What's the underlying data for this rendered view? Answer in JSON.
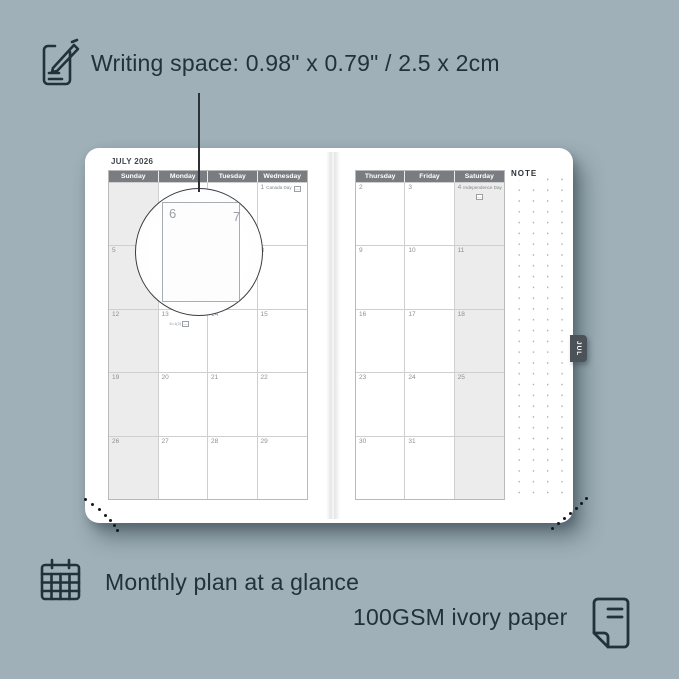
{
  "colors": {
    "background": "#9fb0b8",
    "ink": "#22313a",
    "calendar_header_bg": "#797d82",
    "calendar_header_text": "#ffffff",
    "shaded_column": "#ececec",
    "grid_line": "#cfcfcf",
    "date_text": "#8b9096",
    "month_tab_bg": "#4b5258",
    "note_dot": "#aeb2b6"
  },
  "top_annotation": {
    "text": "Writing space: 0.98\" x 0.79\" / 2.5 x 2cm"
  },
  "bottom_annotations": {
    "monthly": "Monthly plan at a glance",
    "paper": "100GSM ivory paper"
  },
  "planner": {
    "month_title": "JULY 2026",
    "tab_label": "JUL",
    "note_label": "NOTE",
    "left_page": {
      "day_headers": [
        "Sunday",
        "Monday",
        "Tuesday",
        "Wednesday"
      ],
      "rows": [
        [
          {},
          {},
          {},
          {
            "date": "1",
            "label": "Canada Day",
            "icon": "maple-leaf"
          }
        ],
        [
          {
            "date": "5"
          },
          {
            "date": "6"
          },
          {
            "date": "7"
          },
          {
            "date": "8"
          }
        ],
        [
          {
            "date": "12"
          },
          {
            "date": "13",
            "sub": "6=1(2)",
            "sub_icon": true
          },
          {
            "date": "14"
          },
          {
            "date": "15"
          }
        ],
        [
          {
            "date": "19"
          },
          {
            "date": "20"
          },
          {
            "date": "21"
          },
          {
            "date": "22"
          }
        ],
        [
          {
            "date": "26"
          },
          {
            "date": "27"
          },
          {
            "date": "28"
          },
          {
            "date": "29"
          }
        ]
      ]
    },
    "right_page": {
      "day_headers": [
        "Thursday",
        "Friday",
        "Saturday"
      ],
      "rows": [
        [
          {
            "date": "2"
          },
          {
            "date": "3"
          },
          {
            "date": "4",
            "label": "Independence Day",
            "icon": "us-flag",
            "icon_below": true
          }
        ],
        [
          {
            "date": "9"
          },
          {
            "date": "10"
          },
          {
            "date": "11"
          }
        ],
        [
          {
            "date": "16"
          },
          {
            "date": "17"
          },
          {
            "date": "18"
          }
        ],
        [
          {
            "date": "23"
          },
          {
            "date": "24"
          },
          {
            "date": "25"
          }
        ],
        [
          {
            "date": "30"
          },
          {
            "date": "31"
          },
          {}
        ]
      ]
    },
    "magnifier": {
      "day_left": "6",
      "day_right": "7"
    }
  }
}
